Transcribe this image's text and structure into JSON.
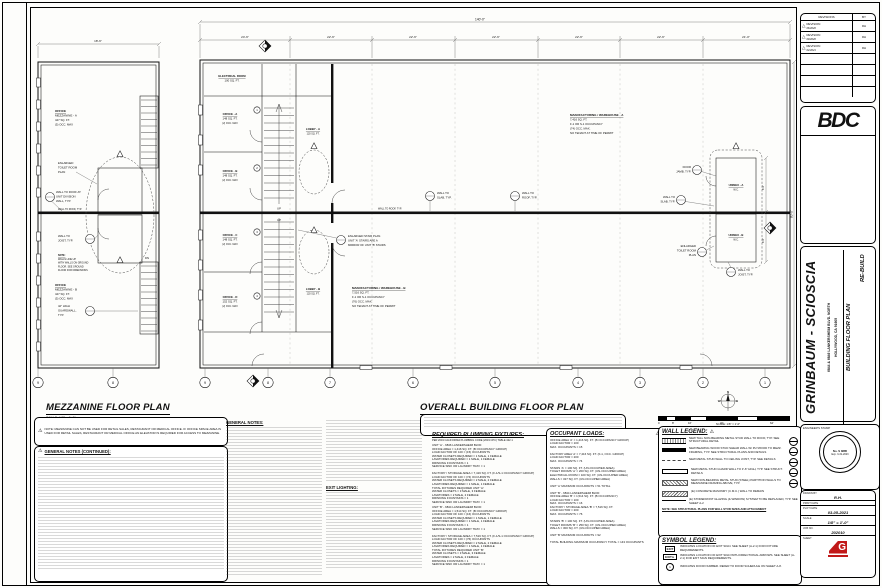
{
  "icons": {
    "warning": "⚠",
    "rev_triangle": "△",
    "exit_arrow": "►"
  },
  "titles": {
    "mezzanine": "MEZZANINE FLOOR PLAN",
    "mezzanine_scale": "SCALE: 1/8\" = 1'-0\"",
    "overall": "OVERALL BUILDING FLOOR PLAN",
    "overall_scale": "SCALE: 1/8\" = 1'-0\"",
    "plan_north": "PLAN NORTH",
    "plan_north_scale": "SCALE: 1/8\" = 1'-0\""
  },
  "notes": {
    "mezz_note": "NOTE: MEZZANINE CAN NOT BE USED FOR RETAIL SALES, RESTAURANT OR MEDICAL OFFICE. IF OFFICE SPACE AREA IS USED FOR RETAIL SALES, RESTAURANT OR MEDICAL OFFICE AN ELEVATOR IS REQUIRED FOR ACCESS TO MEZZANINE.",
    "general_continued_header": "GENERAL NOTES (CONTINUED):",
    "general_header": "GENERAL NOTES:",
    "exit_header": "EXIT LIGHTING:",
    "wall_note": "NOTE: SEE STRUCTURAL PLANS FOR WALL STUD SIZES AND ATTACHMENT"
  },
  "plumbing": {
    "header": "REQUIRED PLUMBING FIXTURES:",
    "sub": "PER 2019 CALIFORNIA PLUMBING CODE (2019 CPC) TABLE 422.1",
    "text_a": "UNIT 'A' - 6846 LANKERSHEIM BLVD:\nOFFICE AREA = 1,416 SQ. FT. (B OCCUPANCY GROUP)\nLOAD FACTOR OF 100 = (15) OCCUPANTS\nWATER CLOSETS REQUIRED = 1 MALE, 1 FEMALE\nLAVATORIES REQUIRED = 1 MALE, 1 FEMALE\nDRINKING FOUNTAINS = 1\nSERVICE SINK OR LAUNDRY TRAY = 1\n\nFACTORY / STORAGE AREA = 7,416 SQ. FT. (F-1/S-1 OCCUPANCY GROUP)\nLOAD FACTOR OF 100 = (74) OCCUPANTS\nWATER CLOSETS REQUIRED = 2 MALE, 2 FEMALE\nLAVATORIES REQUIRED = 1 MALE, 1 FEMALE\nTOTAL FIXTURES REQUIRED UNIT 'A':\nWATER CLOSETS = 3 MALE, 3 FEMALE\nLAVATORIES = 2 MALE, 2 FEMALE\nDRINKING FOUNTAINS = 1\nSERVICE SINK OR LAUNDRY TRAY = 1",
    "text_b": "UNIT 'B' - 6844 LANKERSHEIM BLVD:\nOFFICE AREA = 1,514 SQ. FT. (B OCCUPANCY GROUP)\nLOAD FACTOR OF 100 = (16) OCCUPANTS\nWATER CLOSETS REQUIRED = 1 MALE, 1 FEMALE\nLAVATORIES REQUIRED = 1 MALE, 1 FEMALE\nDRINKING FOUNTAINS = 1\nSERVICE SINK OR LAUNDRY TRAY = 1\n\nFACTORY / STORAGE AREA = 7,516 SQ. FT. (F-1/S-1 OCCUPANCY GROUP)\nLOAD FACTOR OF 100 = (76) OCCUPANTS\nWATER CLOSETS REQUIRED = 2 MALE, 2 FEMALE\nLAVATORIES REQUIRED = 1 MALE, 1 FEMALE\nTOTAL FIXTURES REQUIRED UNIT 'B':\nWATER CLOSETS = 3 MALE, 3 FEMALE\nLAVATORIES = 2 MALE, 2 FEMALE\nDRINKING FOUNTAINS = 1\nSERVICE SINK OR LAUNDRY TRAY = 1"
  },
  "occupant": {
    "header": "OCCUPANT LOADS:",
    "text": "OFFICE AREA 'A' = 1,416 SQ. FT. (B OCCUPANCY GROUP)\nLOAD FACTOR = 100\nMAX. OCCUPANTS = 15\n\nFACTORY AREA 'A' = 7,416 SQ. FT. (F-1, OCC. GROUP)\nLOAD FACTOR = 200\nMAX. OCCUPANTS = 74\n\nSTAIRS 'A' = 100 SQ. FT. (UN-OCCUPIED AREA)\nTOILET ROOMS 'A' = 200 SQ. FT. (UN-OCCUPIED AREA)\nELECTRICAL ROOM = 100 SQ. FT. (UN-OCCUPIED AREA)\nWALLS = 327 SQ. FT. (UN-OCCUPIED AREA)\n\nUNIT 'A' MAXIMUM OCCUPANTS = 51 TOTAL\n\nUNIT 'B' - 6844 LANKERSHEIM BLVD:\nOFFICE AREA 'B' = 1,514 SQ. FT. (B OCCUPANCY)\nLOAD FACTOR = 100\nMAX. OCCUPANTS = 16\nFACTORY / STORAGE AREA 'B' = 7,516 SQ. FT.\nLOAD FACTOR = 200\nMAX. OCCUPANTS = 76\n\nSTAIRS 'B' = 100 SQ. FT. (UN-OCCUPIED AREA)\nTOILET ROOMS 'B' = 250 SQ. FT. (UN-OCCUPIED AREA)\nWALLS = 300 SQ. FT. (UN-OCCUPIED AREA)\n\nUNIT 'B' MAXIMUM OCCUPANTS = 92\n\nTOTAL BUILDING MAXIMUM OCCUPANCY TOTAL = 143 OCCUPANTS"
  },
  "wall_legend": {
    "header": "WALL LEGEND:",
    "items": [
      "NEW TALL NON-BEARING METAL STUD WALL TO ROOF, TYP. SEE STRUCTURAL DETAIL",
      "NEW BEARING WOOD STUD SHEAR WALL W/ PLYWOOD TO MEZZ. FRAMING, TYP. SEE STRUCTURAL PLANS AND DETAILS",
      "NEW METAL STUD WALL TO CEILING JOIST, TYP. SEE DETAILS",
      "NEW METAL STUD GUARD WALL TO 3'-6\" HIGH, TYP. SEE STRUCT. DETAILS",
      "NEW NON-BEARING METAL STUD (STEEL) PARTITION WALLS TO MEZZANINE FRAMING ABOVE, TYP.",
      "(E) CONCRETE MASONRY (C.M.U.) WALL TO REMAIN",
      "(E) STOREFRONT GLAZING (& WINDOW) SYSTEM TO BE REPLACED, TYP. SEE SHEET A-2"
    ]
  },
  "symbol_legend": {
    "header": "SYMBOL LEGEND:",
    "exit_label": "EXIT",
    "door_num": "1",
    "items": [
      "INDICATES LOCATION OF EXIT SIGN. SEE SHEET (A-2.1) FOR FIXTURE REQUIREMENTS.",
      "INDICATES LOCATION OF EXIT SIGN WITH DIRECTIONAL ARROWS. SEE SHEET (A-2.1) FOR EXIT SIGN REQUIREMENTS.",
      "INDICATES DOOR NUMBER. REFER TO DOOR SCHEDULE ON SHEET A-8."
    ]
  },
  "scalebar": {
    "t0": "0",
    "t1": "8'",
    "t2": "16'",
    "t3": "32'",
    "t4": "64'"
  },
  "plan": {
    "compass": {
      "n": "N",
      "e": "E",
      "s": "S",
      "w": "W"
    },
    "grid_mezz": [
      "9",
      "8"
    ],
    "grid": [
      "9",
      "8",
      "7",
      "6",
      "5",
      "4",
      "3",
      "2",
      "1"
    ],
    "door_nums": [
      "1",
      "2",
      "3",
      "4"
    ],
    "dims": {
      "overall": "140'-0\"",
      "seg1": "24'-6\"",
      "seg2": "22'-6\"",
      "seg3": "22'-6\"",
      "seg4": "22'-6\"",
      "seg5": "22'-6\"",
      "seg6": "22'-6\"",
      "seg7": "21'-0\"",
      "mezz_top": "18'-6\"",
      "right_v": "80'-0\"",
      "toilet_a": "8'-0\"",
      "toilet_b": "8'-0\""
    },
    "rooms": {
      "electrical": [
        "ELECTRICAL ROOM",
        "100 SQ. FT."
      ],
      "office_a": [
        "OFFICE - A",
        "148 SQ. FT.",
        "(2) OCC. MAX"
      ],
      "office_b": [
        "OFFICE - B",
        "148 SQ. FT.",
        "(2) OCC. MAX"
      ],
      "office_c": [
        "OFFICE - C",
        "148 SQ. FT.",
        "(2) OCC. MAX"
      ],
      "office_d": [
        "OFFICE - D",
        "152 SQ. FT.",
        "(2) OCC. MAX"
      ],
      "lobby_a": [
        "LOBBY - A",
        "120 SQ. FT."
      ],
      "lobby_b": [
        "LOBBY - B",
        "120 SQ. FT."
      ],
      "mfg_a": [
        "MANUFACTURING / WAREHOUSE - A",
        "7,416 SQ. FT.",
        "F-1 OR S-1 OCCUPANCY",
        "(74) OCC. MAX.",
        "NO TENANT AT TIME OF PERMIT"
      ],
      "mfg_b": [
        "MANUFACTURING / WAREHOUSE - B",
        "7,516 SQ. FT.",
        "F-1 OR S-1 OCCUPANCY",
        "(76) OCC. MAX.",
        "NO TENANT AT TIME OF PERMIT"
      ],
      "unisex_a": [
        "UNISEX - A",
        "W.C."
      ],
      "unisex_b": [
        "UNISEX - B",
        "W.C."
      ],
      "mezz_a": [
        "OFFICE",
        "MEZZANINE - A",
        "447 SQ. FT.",
        "(5) OCC. MAX"
      ],
      "mezz_b": [
        "OFFICE",
        "MEZZANINE - B",
        "447 SQ. FT.",
        "(5) OCC. MAX"
      ]
    },
    "callouts": {
      "wall_roof_unit": [
        "WALL TO ROOF AT",
        "UNIT DIVISION",
        "WALL, TYP."
      ],
      "wall_roof_typ": "WALL TO ROOF, TYP.",
      "wall_slab": [
        "WALL TO",
        "SLAB, TYP."
      ],
      "wall_roof2": [
        "WALL TO",
        "ROOF, TYP."
      ],
      "wall_joist": [
        "WALL TO",
        "JOIST, TYP."
      ],
      "door_jamb": [
        "DOOR",
        "JAMB, TYP."
      ],
      "enlarged_toilet": [
        "ENLARGED",
        "TOILET ROOM",
        "PLAN"
      ],
      "enlarged_stair": [
        "ENLARGED STAIR PLAN.",
        "UNIT 'A' STAIRS ARE A",
        "MIRROR OF UNIT 'B' STAIRS"
      ],
      "guardwall": [
        "42\" HIGH",
        "GUARDWALL,",
        "TYP."
      ],
      "mezz_note": [
        "NOTE:",
        "WALLS LINE UP",
        "WITH WALLS ON GROUND",
        "FLOOR. SEE GROUND",
        "FLOOR FOR DIMENSIONS"
      ],
      "up": "UP",
      "dn": "DN"
    }
  },
  "titleblock": {
    "revisions": {
      "header": "REVISIONS",
      "by_header": "BY",
      "rows": [
        {
          "label": "REVISION",
          "date": "06/2020",
          "by": "RH"
        },
        {
          "label": "REVISION",
          "date": "09/2020",
          "by": "RH"
        },
        {
          "label": "REVISION",
          "date": "02/2021",
          "by": "RH"
        }
      ]
    },
    "logo": "BDC",
    "project_name": "GRINBAUM - SCIOSCIA",
    "address_line1": "6844 & 6846 LANKERSHEIM BLVD. NORTH",
    "address_line2": "HOLLYWOOD, CA 91605",
    "sheet_title": "BUILDING FLOOR PLAN",
    "phase": "RE-BUILD",
    "stamp_label": "ENGINEER'S STAMP",
    "stamp_no": "No. S 3885",
    "stamp_exp": "Exp. 3-31-2023",
    "drawn_by_label": "DRAWN BY",
    "drawn_by": "R.H.",
    "print_date_label": "PRINT DATE",
    "plot_date_label": "PLOT DATE",
    "plot_date": "03-05-2021",
    "scale_label": "SCALE",
    "scale": "1/8\" = 1'-0\"",
    "job_label": "JOB NO.",
    "job_no": "202010",
    "sheet_label": "SHEET"
  }
}
